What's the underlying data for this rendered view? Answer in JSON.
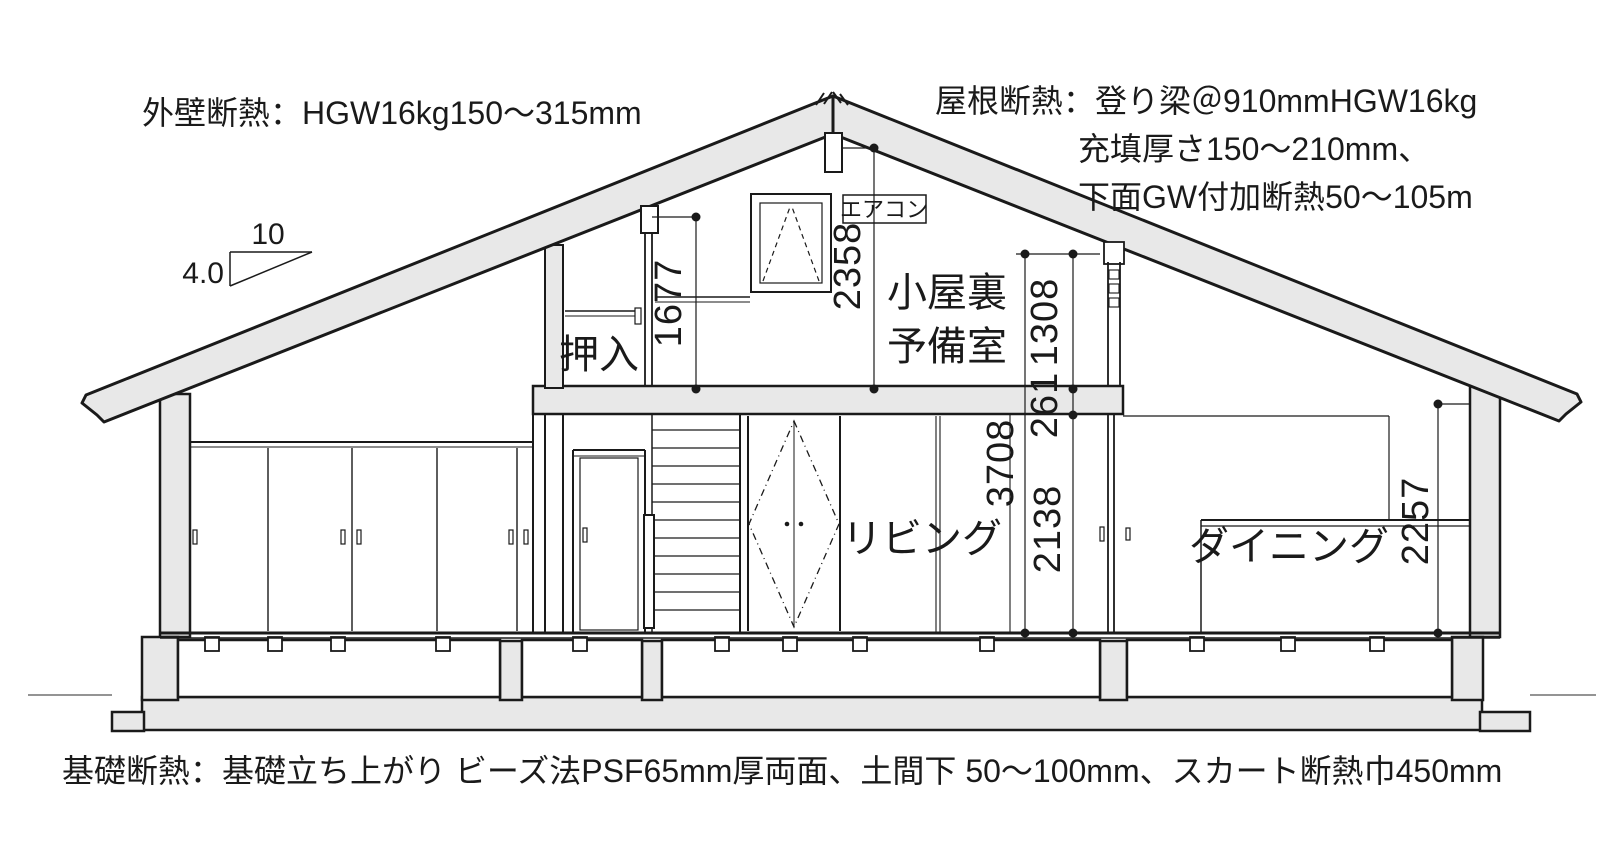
{
  "drawing": {
    "type": "house-cross-section",
    "annotations": {
      "exterior_wall": "外壁断熱：HGW16kg150〜315mm",
      "roof_line1": "屋根断熱：登り梁＠910mmHGW16kg",
      "roof_line2": "充填厚さ150〜210mm、",
      "roof_line3": "下面GW付加断熱50〜105m",
      "foundation": "基礎断熱：基礎立ち上がり ビーズ法PSF65mm厚両面、土間下 50〜100mm、スカート断熱巾450mm"
    },
    "slope_symbol": {
      "run": "10",
      "rise": "4.0"
    },
    "rooms": {
      "closet": "押入",
      "attic_line1": "小屋裏",
      "attic_line2": "予備室",
      "living": "リビング",
      "dining": "ダイニング",
      "aircon": "エアコン"
    },
    "dimensions_mm": {
      "loft_wall_height": "1677",
      "loft_peak_height": "2358",
      "loft_room_height": "1308",
      "loft_floor_thickness": "261",
      "overall_inner_height": "3708",
      "first_floor_ceiling_height": "2138",
      "dining_wall_height": "2257"
    },
    "colors": {
      "line": "#1a1a1a",
      "section_fill": "#e8e8e8",
      "paper": "#ffffff"
    }
  }
}
